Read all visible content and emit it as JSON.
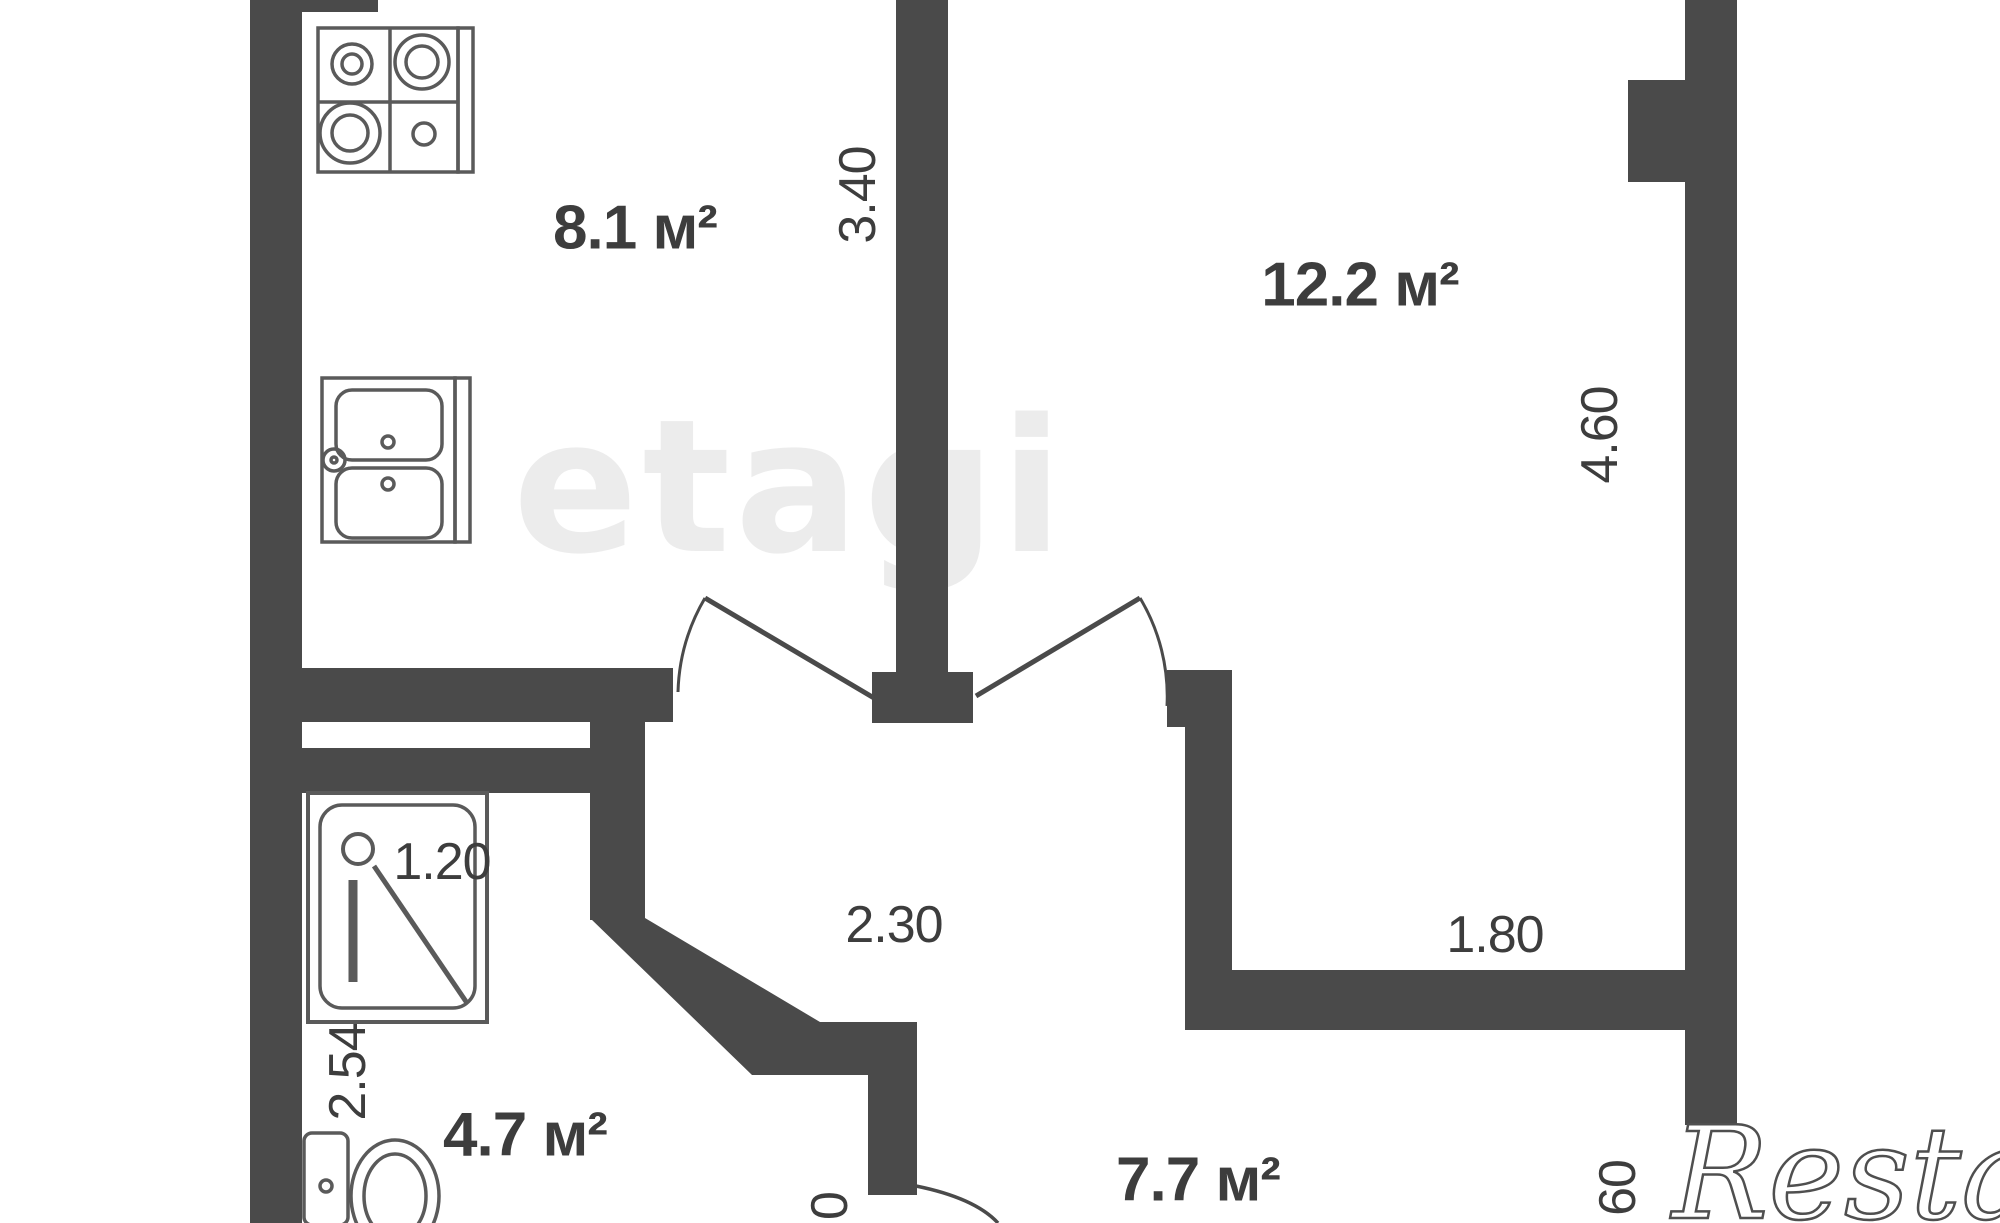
{
  "plan": {
    "rooms": [
      {
        "id": "kitchen",
        "area": "8.1 м²"
      },
      {
        "id": "room",
        "area": "12.2 м²"
      },
      {
        "id": "bathroom",
        "area": "4.7 м²"
      },
      {
        "id": "hallway",
        "area": "7.7 м²"
      }
    ],
    "dims": {
      "kitchen_height": "3.40",
      "room_height": "4.60",
      "shower_width": "1.20",
      "corridor_width": "2.30",
      "niche_width": "1.80",
      "bathroom_height": "2.54",
      "cut_right": "60",
      "cut_bottom": "0"
    },
    "watermarks": {
      "center": "etagi",
      "corner": "Restate"
    },
    "colors": {
      "wall": "#4a4a4a",
      "fixture_line": "#5a5a5a",
      "label_text": "#3d3d3d",
      "watermark_gray": "#dcdcdc"
    }
  }
}
